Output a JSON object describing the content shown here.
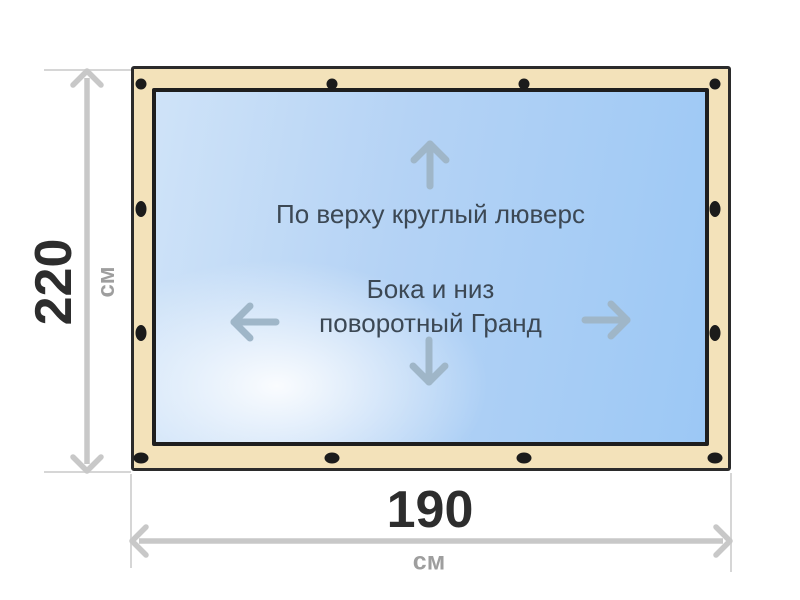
{
  "diagram": {
    "product": {
      "top_note": "По верху круглый люверс",
      "middle_note_line1": "Бока и низ",
      "middle_note_line2": "поворотный Гранд"
    },
    "dimensions": {
      "height": {
        "value": "220",
        "unit": "см"
      },
      "width": {
        "value": "190",
        "unit": "см"
      }
    },
    "colors": {
      "background": "#ffffff",
      "frame_fill": "#f3e2ba",
      "frame_border": "#2b2b2b",
      "panel_border": "#1e1e1e",
      "panel_blue_light": "#cfe3f8",
      "panel_blue_strong": "#9cc8f5",
      "grommet": "#1b1b1b",
      "note_text": "#3c4854",
      "inner_arrow": "#9fb6c8",
      "dimension_line": "#c8c8c8",
      "extension_line": "#d6d6d6",
      "dimension_value_text": "#2d2d2d",
      "dimension_unit_text": "#9e9e9e"
    }
  }
}
